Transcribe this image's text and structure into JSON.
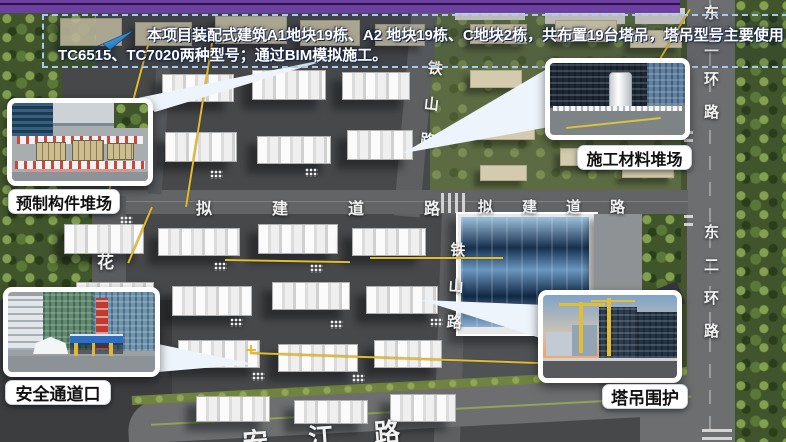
{
  "banner": {
    "line1": "本项目装配式建筑A1地块19栋、A2 地块19栋、C地块2栋，共布置19台塔吊，塔吊型号主要使用",
    "line2": "TC6515、TC7020两种型号；通过BIM模拟施工。",
    "arrow_icon": "blue-swoosh-arrow",
    "border_color": "#a9c9ea",
    "text_color": "#ffffff"
  },
  "top_bar": {
    "color": "#6e3fa3"
  },
  "callouts": {
    "precast_yard": {
      "label": "预制构件堆场"
    },
    "material_yard": {
      "label": "施工材料堆场"
    },
    "safety_passage": {
      "label": "安全通道口"
    },
    "crane_enclosure": {
      "label": "塔吊围护"
    }
  },
  "map": {
    "road_labels": {
      "east_ring_top": "东二环路",
      "east_ring_bottom": "东二环路",
      "tieshan_top": "铁山路",
      "tieshan_bottom": "铁山路",
      "proposed_left": "拟建道路",
      "proposed_right": "拟建道路",
      "anjiang": "安江路",
      "hua_partial": "花"
    },
    "crane_line_color": "#e4bc2e",
    "road_text_color": "#f2f2f2"
  }
}
